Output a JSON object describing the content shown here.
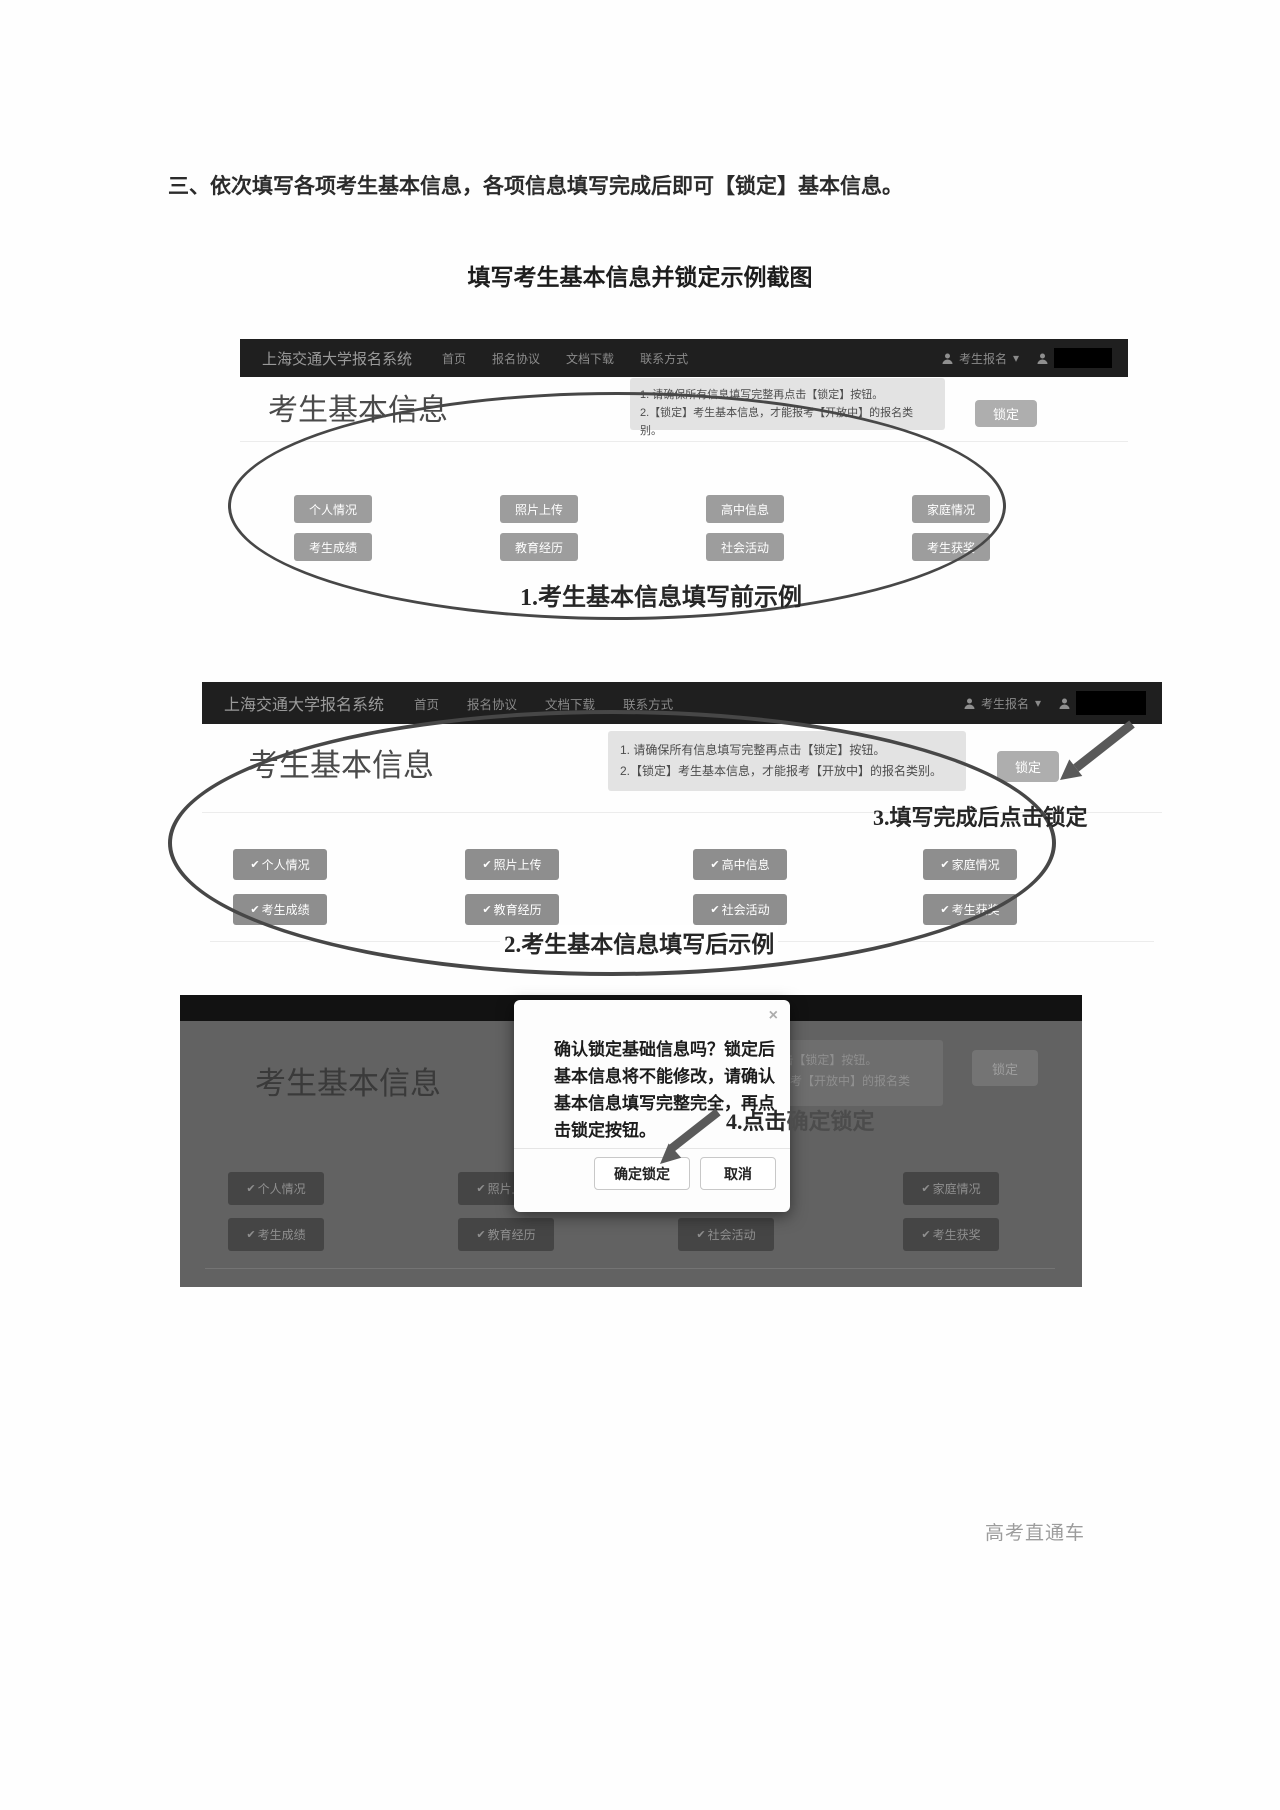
{
  "document": {
    "title": "三、依次填写各项考生基本信息，各项信息填写完成后即可【锁定】基本信息。",
    "subtitle": "填写考生基本信息并锁定示例截图",
    "watermark": "高考直通车"
  },
  "navbar": {
    "brand": "上海交通大学报名系统",
    "menu": [
      "首页",
      "报名协议",
      "文档下载",
      "联系方式"
    ],
    "user_dropdown": "考生报名",
    "caret": "▾"
  },
  "page_heading": "考生基本信息",
  "notice": {
    "line1": "1. 请确保所有信息填写完整再点击【锁定】按钮。",
    "line2": "2.【锁定】考生基本信息，才能报考【开放中】的报名类别。"
  },
  "lock_button_label": "锁定",
  "check": "✔",
  "sections": [
    "个人情况",
    "照片上传",
    "高中信息",
    "家庭情况",
    "考生成绩",
    "教育经历",
    "社会活动",
    "考生获奖"
  ],
  "annotations": {
    "caption1": "1.考生基本信息填写前示例",
    "caption2": "2.考生基本信息填写后示例",
    "step3": "3.填写完成后点击锁定",
    "step4_on_modal": "4.点击",
    "step4_behind": "确定锁定"
  },
  "modal": {
    "close": "×",
    "message": "确认锁定基础信息吗？锁定后基本信息将不能修改，请确认基本信息填写完整完全，再点击锁定按钮。",
    "confirm_label": "确定锁定",
    "cancel_label": "取消"
  },
  "colors": {
    "navbar_bg": "#1f1f1f",
    "notice_bg": "#e3e3e3",
    "button_gray": "#9d9d9d",
    "lock_gray": "#aeaeae",
    "overlay_gray": "#626262",
    "annotation_stroke": "#474747"
  }
}
